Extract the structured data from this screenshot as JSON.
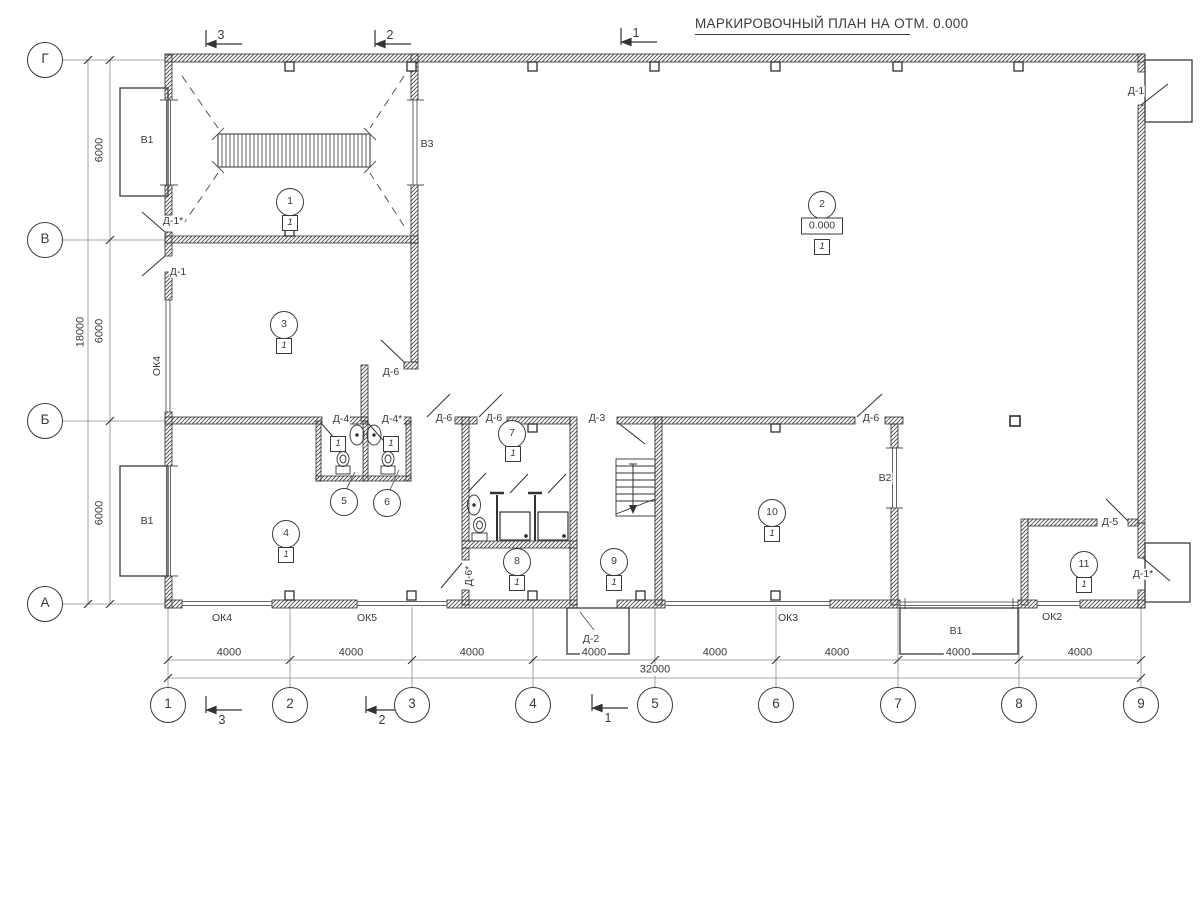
{
  "title": "МАРКИРОВОЧНЫЙ ПЛАН НА ОТМ. 0.000",
  "colors": {
    "ink": "#3a3a3a",
    "wall": "#2f2f2f",
    "thin": "#6e6e6e"
  },
  "grid": {
    "columns": [
      {
        "label": "1",
        "x": 168
      },
      {
        "label": "2",
        "x": 290
      },
      {
        "label": "3",
        "x": 412
      },
      {
        "label": "4",
        "x": 533
      },
      {
        "label": "5",
        "x": 655
      },
      {
        "label": "6",
        "x": 776
      },
      {
        "label": "7",
        "x": 898
      },
      {
        "label": "8",
        "x": 1019
      },
      {
        "label": "9",
        "x": 1141
      }
    ],
    "rows": [
      {
        "label": "Г",
        "y": 60
      },
      {
        "label": "В",
        "y": 240
      },
      {
        "label": "Б",
        "y": 421
      },
      {
        "label": "А",
        "y": 604
      }
    ],
    "bottom_circle_y": 705,
    "left_circle_x": 45
  },
  "dimensions": {
    "bottom_bays": [
      {
        "text": "4000",
        "cx": 229,
        "cy": 653
      },
      {
        "text": "4000",
        "cx": 351,
        "cy": 653
      },
      {
        "text": "4000",
        "cx": 472,
        "cy": 653
      },
      {
        "text": "4000",
        "cx": 594,
        "cy": 653
      },
      {
        "text": "4000",
        "cx": 715,
        "cy": 653
      },
      {
        "text": "4000",
        "cx": 837,
        "cy": 653
      },
      {
        "text": "4000",
        "cx": 958,
        "cy": 653
      },
      {
        "text": "4000",
        "cx": 1080,
        "cy": 653
      }
    ],
    "bottom_total": {
      "text": "32000",
      "cx": 655,
      "cy": 670
    },
    "left_bays": [
      {
        "text": "6000",
        "cx": 100,
        "cy": 150,
        "rotated": true
      },
      {
        "text": "6000",
        "cx": 100,
        "cy": 331,
        "rotated": true
      },
      {
        "text": "6000",
        "cx": 100,
        "cy": 513,
        "rotated": true
      }
    ],
    "left_total": {
      "text": "18000",
      "cx": 81,
      "cy": 332,
      "rotated": true
    }
  },
  "rooms": [
    {
      "number": "1",
      "cx": 290,
      "cy": 202,
      "floor_mark": "1",
      "mark_cx": 290,
      "mark_cy": 223
    },
    {
      "number": "2",
      "cx": 822,
      "cy": 205,
      "floor_mark": "1",
      "mark_cx": 822,
      "mark_cy": 247,
      "elevation": "0.000",
      "elev_cx": 822,
      "elev_cy": 226
    },
    {
      "number": "3",
      "cx": 284,
      "cy": 325,
      "floor_mark": "1",
      "mark_cx": 284,
      "mark_cy": 346
    },
    {
      "number": "4",
      "cx": 286,
      "cy": 534,
      "floor_mark": "1",
      "mark_cx": 286,
      "mark_cy": 555
    },
    {
      "number": "5",
      "cx": 344,
      "cy": 502,
      "floor_mark": "1",
      "mark_cx": 338,
      "mark_cy": 444
    },
    {
      "number": "6",
      "cx": 387,
      "cy": 503,
      "floor_mark": "1",
      "mark_cx": 391,
      "mark_cy": 444
    },
    {
      "number": "7",
      "cx": 512,
      "cy": 434,
      "floor_mark": "1",
      "mark_cx": 513,
      "mark_cy": 454
    },
    {
      "number": "8",
      "cx": 517,
      "cy": 562,
      "floor_mark": "1",
      "mark_cx": 517,
      "mark_cy": 583
    },
    {
      "number": "9",
      "cx": 614,
      "cy": 562,
      "floor_mark": "1",
      "mark_cx": 614,
      "mark_cy": 583
    },
    {
      "number": "10",
      "cx": 772,
      "cy": 513,
      "floor_mark": "1",
      "mark_cx": 772,
      "mark_cy": 534
    },
    {
      "number": "11",
      "cx": 1084,
      "cy": 565,
      "floor_mark": "1",
      "mark_cx": 1084,
      "mark_cy": 585
    }
  ],
  "door_labels": [
    {
      "text": "Д-1*",
      "cx": 173,
      "cy": 221
    },
    {
      "text": "Д-1",
      "cx": 178,
      "cy": 272
    },
    {
      "text": "Д-6",
      "cx": 391,
      "cy": 372
    },
    {
      "text": "Д-4",
      "cx": 341,
      "cy": 419
    },
    {
      "text": "Д-4*",
      "cx": 392,
      "cy": 419
    },
    {
      "text": "Д-6",
      "cx": 444,
      "cy": 418
    },
    {
      "text": "Д-6",
      "cx": 494,
      "cy": 418
    },
    {
      "text": "Д-3",
      "cx": 597,
      "cy": 418
    },
    {
      "text": "Д-6",
      "cx": 871,
      "cy": 418
    },
    {
      "text": "Д-6*",
      "cx": 469,
      "cy": 576,
      "rotated": true
    },
    {
      "text": "Д-2",
      "cx": 591,
      "cy": 639
    },
    {
      "text": "Д-5",
      "cx": 1110,
      "cy": 522
    },
    {
      "text": "Д-1*",
      "cx": 1143,
      "cy": 574
    },
    {
      "text": "Д-1",
      "cx": 1136,
      "cy": 91
    }
  ],
  "window_labels": [
    {
      "text": "ОК4",
      "cx": 157,
      "cy": 366,
      "rotated": true
    },
    {
      "text": "ОК4",
      "cx": 222,
      "cy": 618
    },
    {
      "text": "ОК5",
      "cx": 367,
      "cy": 618
    },
    {
      "text": "ОК3",
      "cx": 788,
      "cy": 618
    },
    {
      "text": "ОК2",
      "cx": 1052,
      "cy": 617
    }
  ],
  "vent_labels": [
    {
      "text": "В1",
      "cx": 147,
      "cy": 140
    },
    {
      "text": "В3",
      "cx": 427,
      "cy": 144
    },
    {
      "text": "В1",
      "cx": 147,
      "cy": 521
    },
    {
      "text": "В2",
      "cx": 885,
      "cy": 478
    },
    {
      "text": "В1",
      "cx": 956,
      "cy": 631
    }
  ],
  "section_marks": {
    "top": [
      {
        "text": "3",
        "cx": 221,
        "cy": 35
      },
      {
        "text": "2",
        "cx": 390,
        "cy": 35
      },
      {
        "text": "1",
        "cx": 636,
        "cy": 33
      }
    ],
    "bottom": [
      {
        "text": "3",
        "cx": 222,
        "cy": 720
      },
      {
        "text": "2",
        "cx": 382,
        "cy": 720
      },
      {
        "text": "1",
        "cx": 608,
        "cy": 718
      }
    ]
  }
}
